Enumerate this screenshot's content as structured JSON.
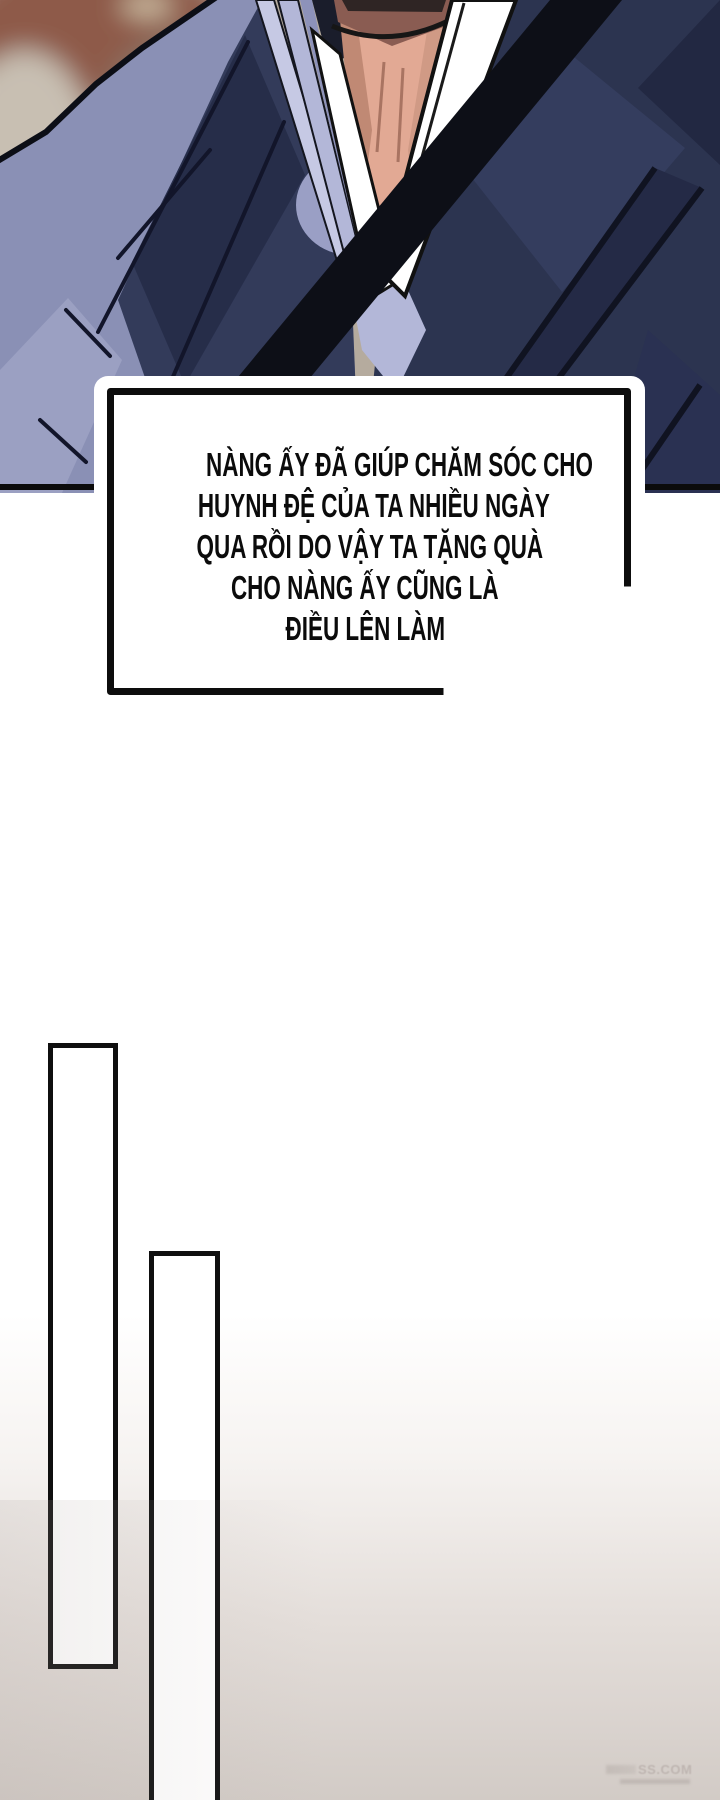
{
  "speech_bubble": {
    "lines": [
      "NÀNG ẤY ĐÃ GIÚP CHĂM SÓC CHO",
      "HUYNH ĐỆ CỦA TA NHIỀU NGÀY",
      "QUA RỒI DO VẬY TA TẶNG QUÀ",
      "CHO NÀNG ẤY CŨNG LÀ",
      "ĐIỀU LÊN LÀM"
    ]
  },
  "watermark": {
    "text": "SS.COM"
  },
  "art": {
    "colors": {
      "bg_base": "#b5ab9e",
      "bg_brick": "#8e5a4a",
      "bg_brown": "#8a7263",
      "bg_tan": "#c8bfb2",
      "bg_olive": "#a9a191",
      "robe_light": "#8a90b5",
      "robe_mid": "#333b5a",
      "robe_dark": "#262d49",
      "robe_right": "#2c3450",
      "robe_facet": "#343d5e",
      "sash_black": "#0d0f17",
      "collar_lavender": "#b3b7d8",
      "collar_light": "#c6c9e4",
      "collar_shadow": "#9a9fc5",
      "skin": "#e2a994",
      "skin_shadow": "#c08974",
      "chin_shadow": "#8a5c52",
      "panel_border": "#0b0b0b",
      "bubble_border": "#0d0d0d",
      "gradient_bottom": "#d2cbc6"
    }
  }
}
